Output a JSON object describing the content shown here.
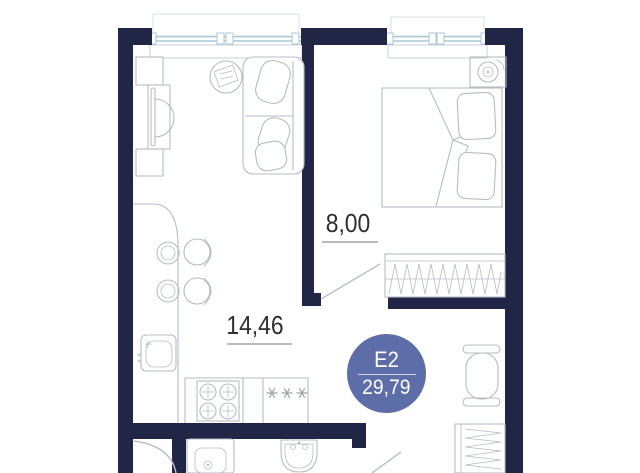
{
  "plan": {
    "title": "apartment-floor-plan",
    "unit_badge": {
      "label": "E2",
      "area": "29,79"
    },
    "rooms": [
      {
        "id": "bedroom",
        "area_label": "8,00"
      },
      {
        "id": "living-kitchen",
        "area_label": "14,46"
      }
    ],
    "colors": {
      "wall": "#212647",
      "window": "#a9c8d6",
      "furniture_outline": "#b6bcc4",
      "badge": "#5d6da7",
      "label_text": "#2e2e2e"
    }
  }
}
